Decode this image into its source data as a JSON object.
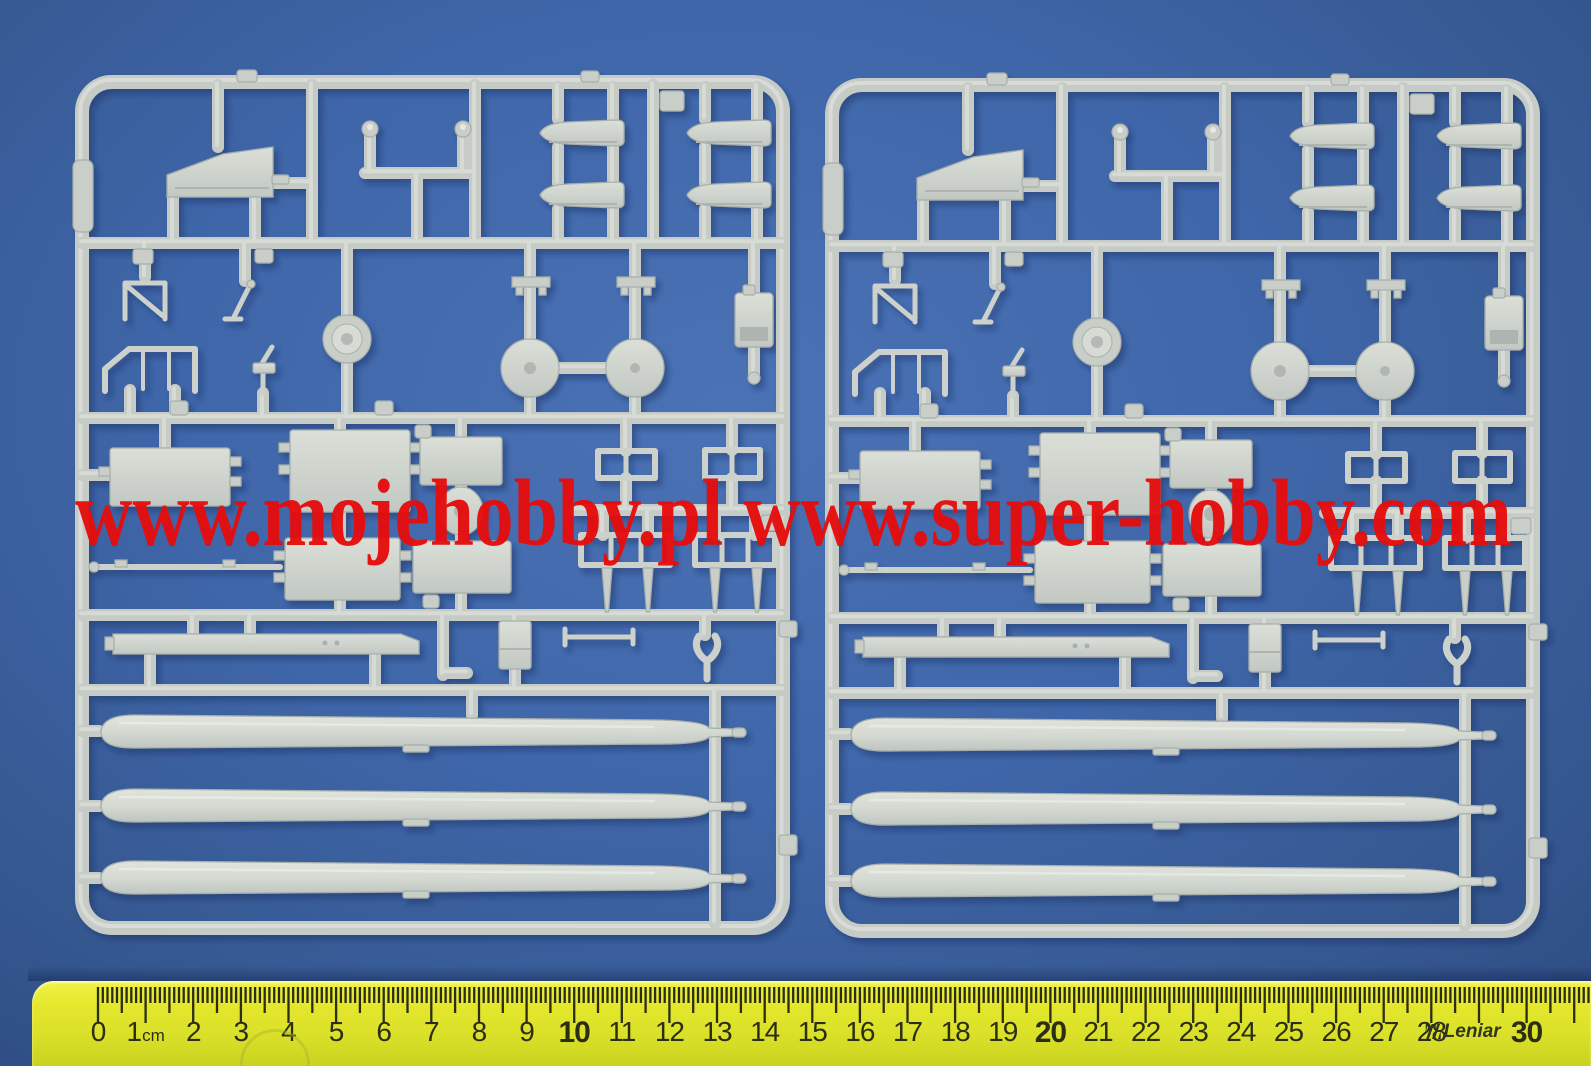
{
  "watermark": {
    "text": "www.mojehobby.pl www.super-hobby.com",
    "color": "#e60d0d"
  },
  "ruler": {
    "unit": "cm",
    "brand": "Leniar",
    "cm_labels": [
      "0",
      "1",
      "2",
      "3",
      "4",
      "5",
      "6",
      "7",
      "8",
      "9",
      "10",
      "11",
      "12",
      "13",
      "14",
      "15",
      "16",
      "17",
      "18",
      "19",
      "20",
      "21",
      "22",
      "23",
      "24",
      "25",
      "26",
      "27",
      "28",
      "",
      "30"
    ]
  },
  "colors": {
    "background-blue": "#3f66a9",
    "sprue-plastic": "#c9cec8",
    "watermark-red": "#e60d0d",
    "ruler-yellow": "#e3e62b",
    "ruler-markings": "#2b2e14"
  }
}
